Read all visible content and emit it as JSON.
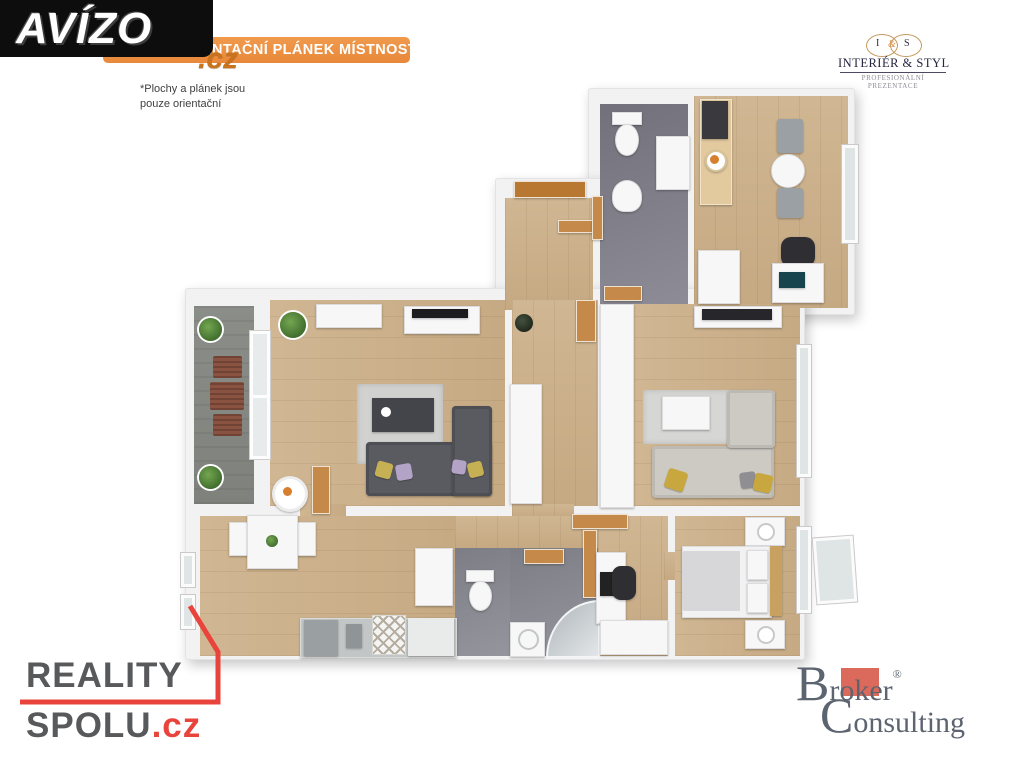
{
  "branding": {
    "avizo": {
      "text": "AVÍZO",
      "suffix": ".cz"
    },
    "banner": {
      "label": "ORIENTAČNÍ PLÁNEK MÍSTNOSTÍ"
    },
    "disclaimer": {
      "line1": "*Plochy  a plánek jsou",
      "line2": "pouze orientační"
    },
    "interier_styl": {
      "monogram_left": "I",
      "monogram_amp": "&",
      "monogram_right": "S",
      "name": "INTERIÉR & STYL",
      "tagline": "PROFESIONÁLNÍ PREZENTACE"
    },
    "reality_spolu": {
      "line1": "REALITY",
      "line2": "SPOLU",
      "suffix": ".cz"
    },
    "broker_consulting": {
      "word1_initial": "B",
      "word1_rest": "roker",
      "registered": "®",
      "word2_initial": "C",
      "word2_rest": "onsulting"
    }
  },
  "colors": {
    "banner_orange": "#E8883A",
    "avizo_black": "#0D0D0D",
    "avizo_cz_orange": "#C9731F",
    "reality_gray": "#58595B",
    "reality_red": "#E8443B",
    "broker_gray": "#5C6470",
    "broker_red": "#DC6A5C",
    "interier_gold": "#C49A5F",
    "interier_navy": "#252540",
    "floor_wood": "#CDB28E",
    "floor_tile": "#82828C",
    "floor_balcony": "#8B8E88",
    "wall_white": "#F2F2F3"
  }
}
